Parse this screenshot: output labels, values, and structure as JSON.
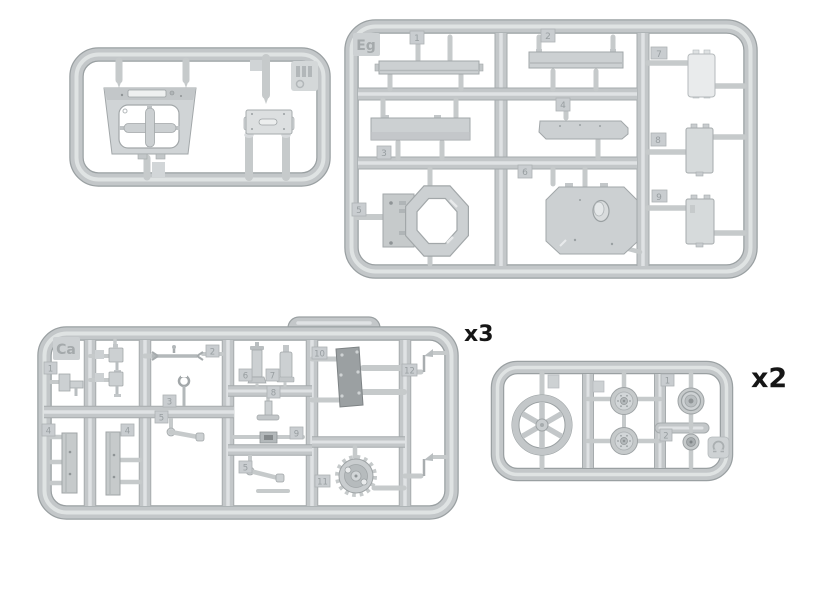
{
  "document": {
    "type": "model-kit-sprue-diagram",
    "background": "#ffffff"
  },
  "palette": {
    "sprue_base": "#c3c7c9",
    "sprue_edge": "#9aa0a2",
    "sprue_highlight": "#e2e5e6",
    "part_fill": "#ccd0d2",
    "part_dark": "#9ba0a2",
    "part_light": "#e9ebec",
    "tag_fill": "#c9cdd0",
    "label_text": "#161616",
    "emboss_text": "#a4a9ab"
  },
  "sprues": {
    "top_left": {
      "id_label": "",
      "quantity_label": "",
      "part_names": [
        "turret-roof-plate",
        "cross-shaped-insert",
        "mount-plate",
        "round-pin",
        "round-pin"
      ],
      "corner_stamp": "mold-stamp"
    },
    "top_right": {
      "id_label": "Eg",
      "quantity_label": "",
      "part_numbers": [
        "1",
        "2",
        "3",
        "4",
        "5",
        "6",
        "7",
        "8",
        "9"
      ],
      "part_names": [
        "long-bar",
        "long-bar",
        "long-bar",
        "beveled-plank",
        "octagon-ring-with-plate",
        "octagonal-hatch-plate",
        "small-hatch-plate",
        "small-hatch-plate",
        "small-hatch-plate"
      ]
    },
    "bottom_left": {
      "id_label": "Ca",
      "quantity_label": "x3",
      "part_numbers": [
        "1",
        "2",
        "3",
        "5",
        "6",
        "7",
        "8",
        "9",
        "10",
        "11",
        "12",
        "4",
        "4",
        "5"
      ],
      "part_names": [
        "bracket",
        "turnbuckle-rod",
        "hook",
        "arm",
        "periscope",
        "cylinder",
        "t-stand",
        "rod-block",
        "dark-plate",
        "sprocket-wheel",
        "antenna",
        "plank",
        "plank",
        "arm"
      ]
    },
    "bottom_right": {
      "id_label": "",
      "quantity_label": "x2",
      "part_numbers": [
        "1",
        "2"
      ],
      "part_names": [
        "six-spoke-idler-wheel",
        "road-wheel",
        "road-wheel",
        "return-roller",
        "small-wheel"
      ],
      "corner_stamp": "material-stamp"
    }
  }
}
